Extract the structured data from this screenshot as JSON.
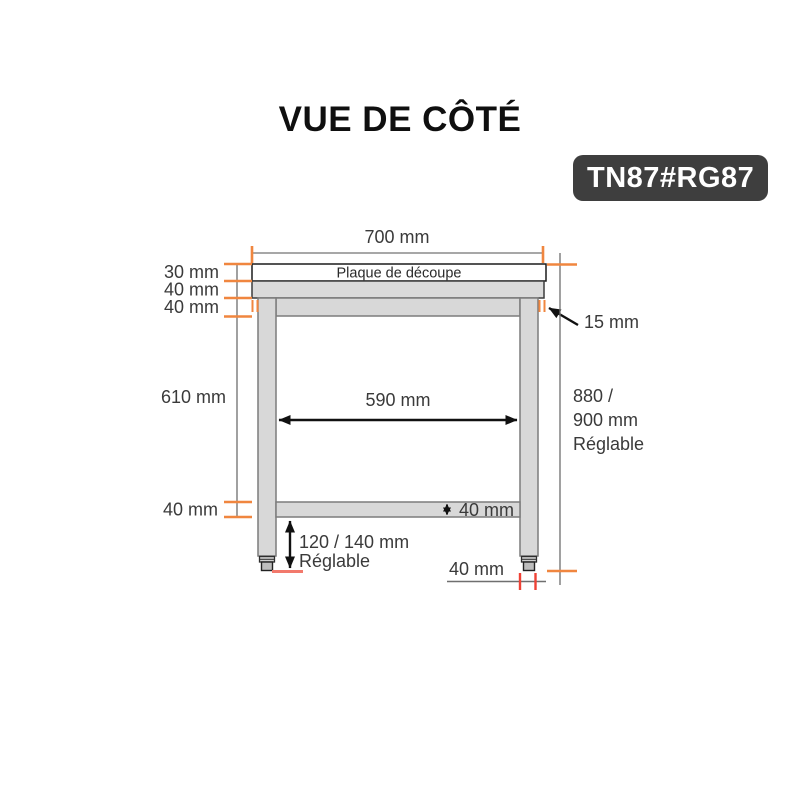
{
  "header": {
    "title": "VUE DE CÔTÉ",
    "product_code": "TN87#RG87"
  },
  "diagram": {
    "top_plate_label": "Plaque de découpe",
    "dimensions": {
      "top_width": "700 mm",
      "plate_thickness": "30 mm",
      "top_frame_thickness": "40 mm",
      "apron_thickness": "40 mm",
      "top_overhang": "15 mm",
      "leg_clearance_height": "610 mm",
      "inner_width": "590 mm",
      "overall_height_line1": "880 /",
      "overall_height_line2": "900 mm",
      "overall_height_line3": "Réglable",
      "shelf_thickness_side": "40 mm",
      "shelf_thickness": "40 mm",
      "foot_height_line1": "120 / 140 mm",
      "foot_height_line2": "Réglable",
      "foot_width": "40 mm"
    },
    "colors": {
      "accent_orange": "#F0863F",
      "accent_red": "#EF4135",
      "accent_salmon": "#F2796C",
      "badge_background": "#3E3E3E",
      "table_fill": "#D8D8D8",
      "dimension_line": "#6E6E6E",
      "label_text": "#3A3A3A"
    }
  }
}
